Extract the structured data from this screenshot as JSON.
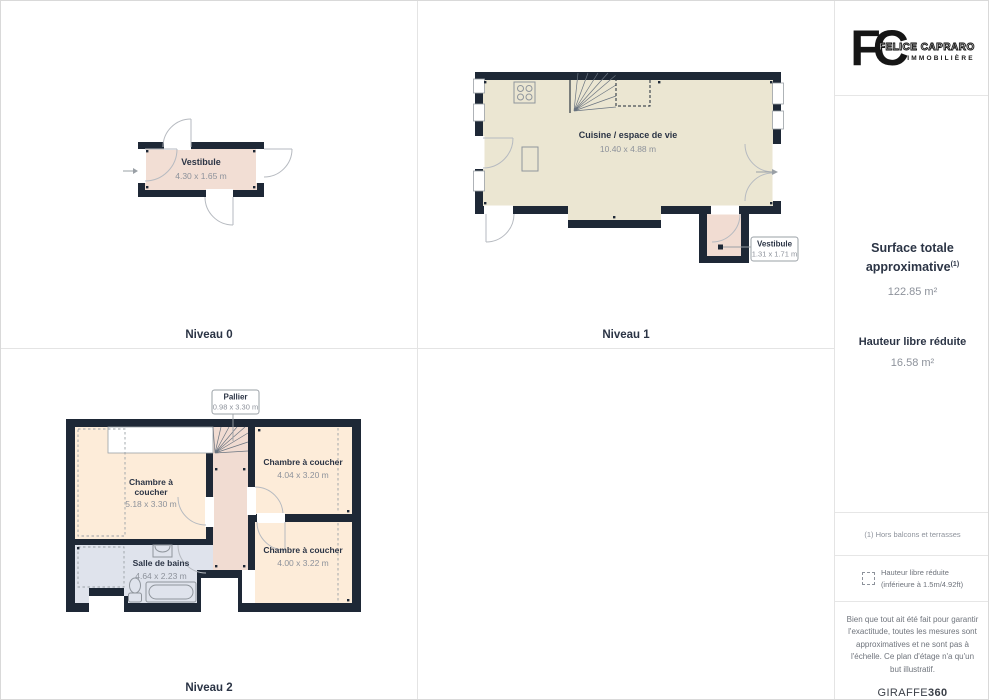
{
  "brand": {
    "monogram": "FC",
    "name": "FELICE CAPRARO",
    "subtitle": "IMMOBILIÈRE"
  },
  "floors": {
    "niveau0": {
      "label": "Niveau 0",
      "vestibule": {
        "name": "Vestibule",
        "dims": "4.30 x 1.65 m"
      }
    },
    "niveau1": {
      "label": "Niveau 1",
      "cuisine": {
        "name": "Cuisine / espace de vie",
        "dims": "10.40 x 4.88 m"
      },
      "vestibule": {
        "name": "Vestibule",
        "dims": "1.31 x 1.71 m"
      }
    },
    "niveau2": {
      "label": "Niveau 2",
      "pallier": {
        "name": "Pallier",
        "dims": "0.98 x 3.30 m"
      },
      "chambre1": {
        "name_line1": "Chambre à",
        "name_line2": "coucher",
        "dims": "5.18 x 3.30 m"
      },
      "chambre2": {
        "name": "Chambre à coucher",
        "dims": "4.04 x 3.20 m"
      },
      "chambre3": {
        "name": "Chambre à coucher",
        "dims": "4.00 x 3.22 m"
      },
      "salle_de_bains": {
        "name": "Salle de bains",
        "dims": "4.64 x 2.23 m"
      }
    }
  },
  "sidebar": {
    "surface_title_line1": "Surface totale",
    "surface_title_line2": "approximative",
    "surface_footnote_marker": "(1)",
    "surface_value": "122.85 m²",
    "reduced_height_title": "Hauteur libre réduite",
    "reduced_height_value": "16.58 m²",
    "footnote": "(1) Hors balcons et terrasses",
    "legend_line1": "Hauteur libre réduite",
    "legend_line2": "(inférieure à 1.5m/4.92ft)",
    "disclaimer": "Bien que tout ait été fait pour garantir l'exactitude, toutes les mesures sont approximatives et ne sont pas à l'échelle. Ce plan d'étage n'a qu'un but illustratif.",
    "watermark_regular": "GIRAFFE",
    "watermark_bold": "360"
  },
  "colors": {
    "wall": "#1e2836",
    "room_cream": "#ebe6d2",
    "room_pink": "#f1dcd2",
    "room_peach": "#fdecd9",
    "room_bath": "#dfe3ec",
    "accent_text": "#2b3445",
    "dim_text": "#8d929b"
  }
}
